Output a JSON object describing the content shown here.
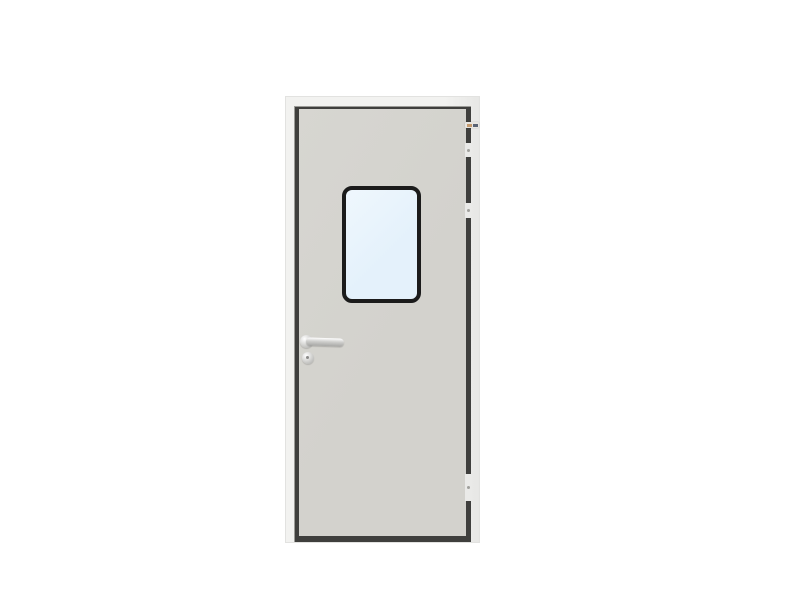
{
  "scene": {
    "type": "product-photo",
    "subject": "steel cleanroom door with vision window, lever handle and hinges",
    "visible_text": ""
  },
  "sticker": {
    "label": ""
  },
  "colors": {
    "background": "#ffffff",
    "frame_face": "#f2f2f0",
    "frame_shade": "#e7e7e5",
    "frame_edge": "#e2e2e0",
    "gap_dark": "#3f3f3d",
    "gap_light_edge": "#9c9c98",
    "leaf": "#d3d2cd",
    "leaf_light": "#d7d6d1",
    "window_frame": "#1b1b1b",
    "glass": "#e4f1fb",
    "glass_light": "#eff7fd",
    "metal": "#cfcfcd",
    "metal_highlight": "#ffffff",
    "metal_shadow": "#a8a8a6",
    "keyhole": "#8a8a88",
    "hinge_light": "#eaeae8",
    "hinge_dot": "#a0a09c",
    "sticker_bg": "#e8e6e2",
    "sticker_orange": "#c49a6e",
    "sticker_blue": "#5a6374"
  }
}
